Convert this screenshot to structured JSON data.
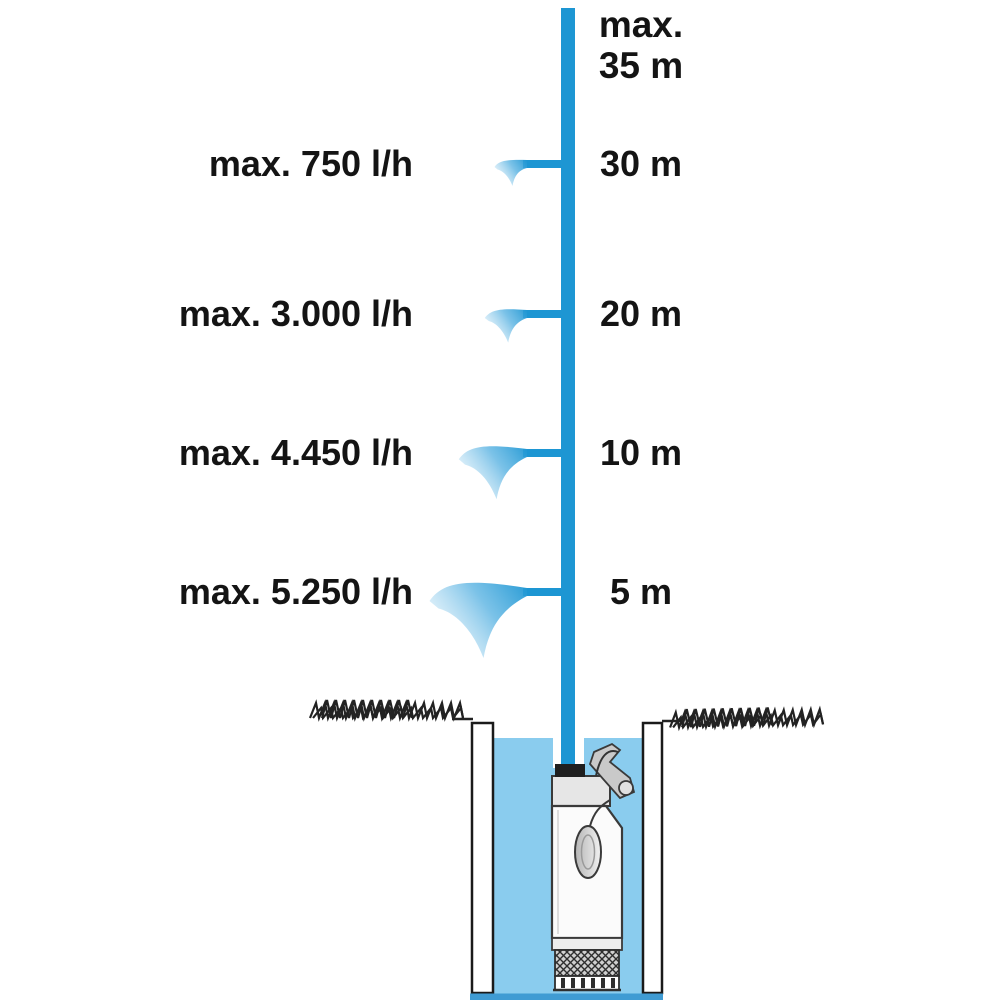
{
  "diagram": {
    "top_note": {
      "prefix": "max.",
      "value": "35 m"
    },
    "levels": [
      {
        "flow": "max. 750 l/h",
        "height": "30 m",
        "flow_l_per_h": 750,
        "head_m": 30
      },
      {
        "flow": "max. 3.000 l/h",
        "height": "20 m",
        "flow_l_per_h": 3000,
        "head_m": 20
      },
      {
        "flow": "max. 4.450 l/h",
        "height": "10 m",
        "flow_l_per_h": 4450,
        "head_m": 10
      },
      {
        "flow": "max. 5.250 l/h",
        "height": "5 m",
        "flow_l_per_h": 5250,
        "head_m": 5
      }
    ],
    "max_head_m": 35,
    "colors": {
      "pipe_blue": "#1d96d3",
      "water_blue": "#8accee",
      "spray_blue": "#5ab3e2",
      "well_bottom_blue": "#3f9bd3",
      "text_black": "#141414"
    }
  }
}
